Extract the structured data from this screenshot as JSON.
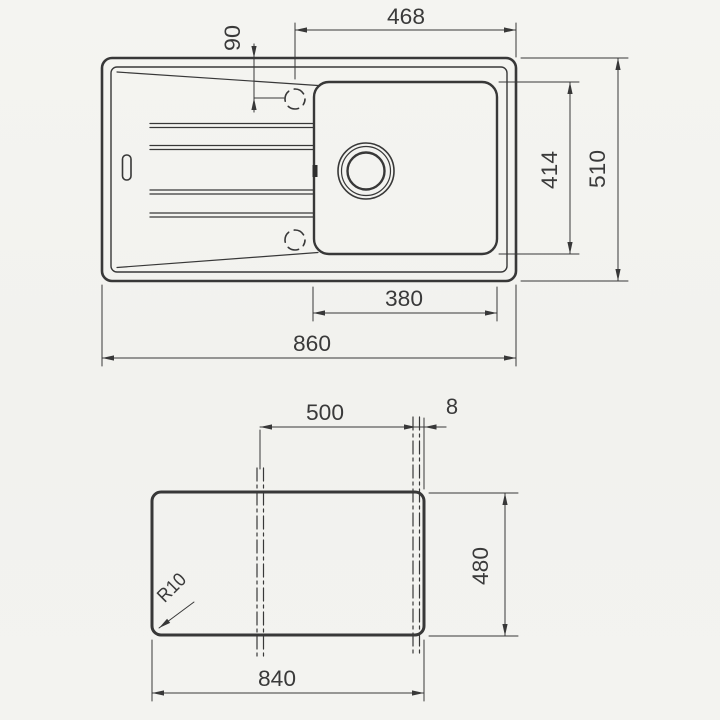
{
  "page": {
    "background": "#f2f2ef",
    "line_color": "#383838",
    "text_color": "#3a3a3a"
  },
  "views": {
    "top_view": {
      "name": "sink top view",
      "dims": {
        "hole_to_right_edge": "468",
        "hole_offset_from_top": "90",
        "bowl_inner_depth": "414",
        "overall_depth": "510",
        "bowl_inner_width": "380",
        "overall_width": "860"
      }
    },
    "cutout_view": {
      "name": "worktop cutout view",
      "dims": {
        "centerline_span": "500",
        "edge_offset": "8",
        "cutout_depth": "480",
        "cutout_width": "840",
        "corner_radius": "R10"
      }
    }
  }
}
